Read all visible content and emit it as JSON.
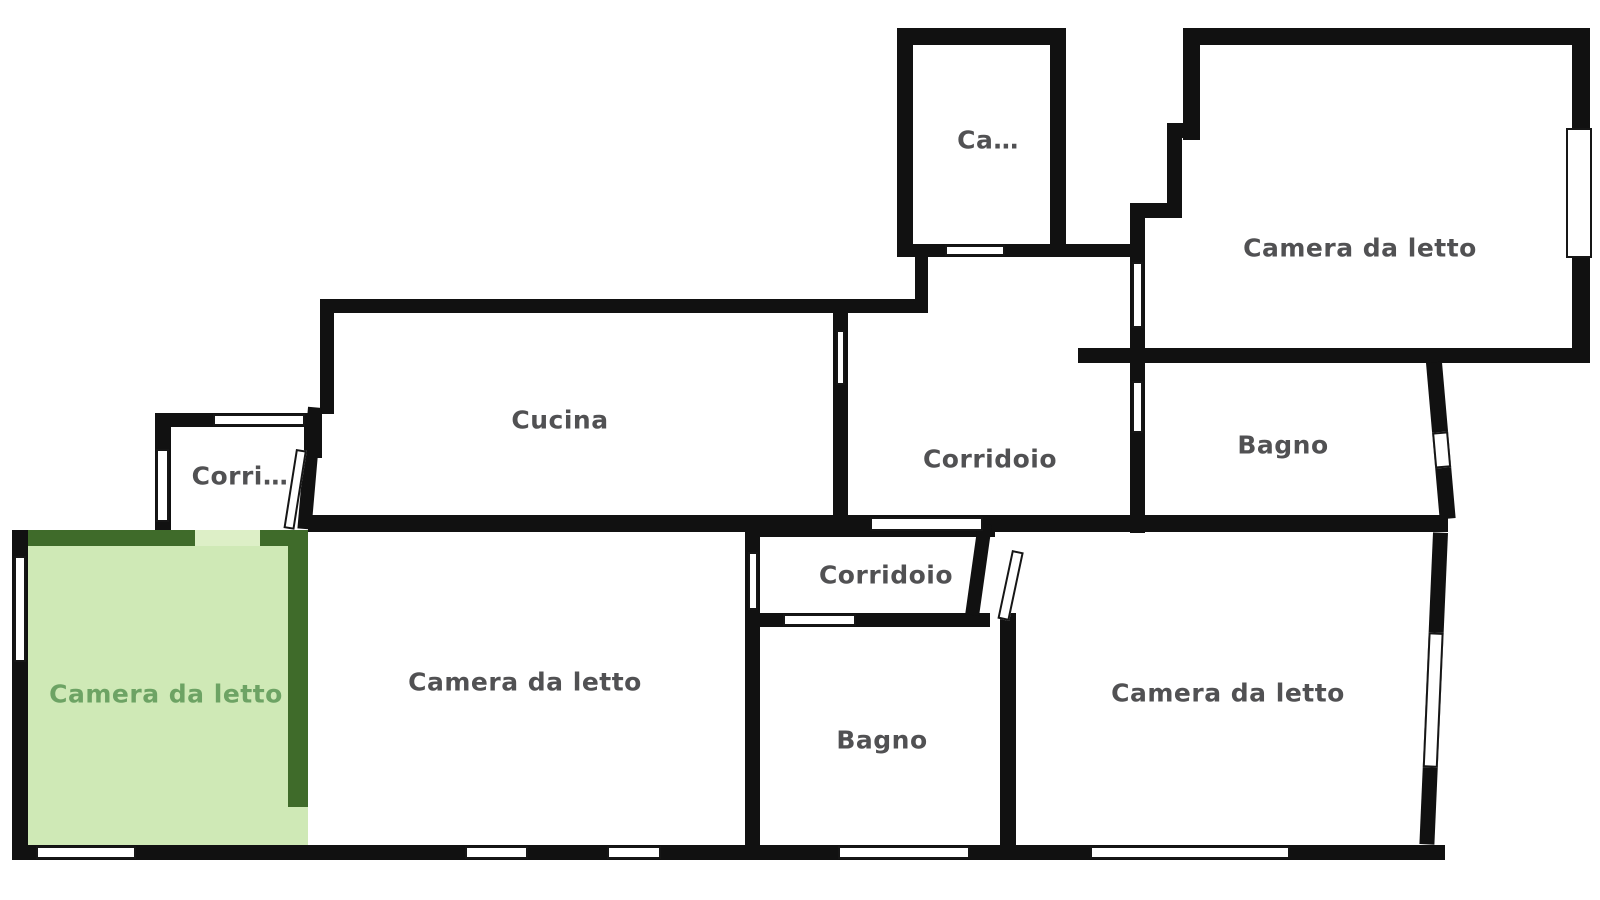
{
  "plan": {
    "title": "Floor plan with Italian room labels, one highlighted bedroom",
    "colors": {
      "background": "#ffffff",
      "wall": "#111111",
      "label": "#515153",
      "highlight_fill": "#cfe9b6",
      "highlight_wall": "#3f6b2a",
      "highlight_label": "#6da364",
      "highlight_door": "#ddefc7"
    },
    "rooms": [
      {
        "id": "cabina",
        "label": "Ca…"
      },
      {
        "id": "bedroom-top-right",
        "label": "Camera da letto"
      },
      {
        "id": "cucina",
        "label": "Cucina"
      },
      {
        "id": "corridoio-middle",
        "label": "Corridoio"
      },
      {
        "id": "bagno-top-right",
        "label": "Bagno"
      },
      {
        "id": "corridoio-left",
        "label": "Corri…"
      },
      {
        "id": "bedroom-left",
        "label": "Camera da letto",
        "highlighted": true
      },
      {
        "id": "bedroom-center",
        "label": "Camera da letto"
      },
      {
        "id": "corridoio-lower",
        "label": "Corridoio"
      },
      {
        "id": "bagno-lower",
        "label": "Bagno"
      },
      {
        "id": "bedroom-right",
        "label": "Camera da letto"
      }
    ]
  }
}
